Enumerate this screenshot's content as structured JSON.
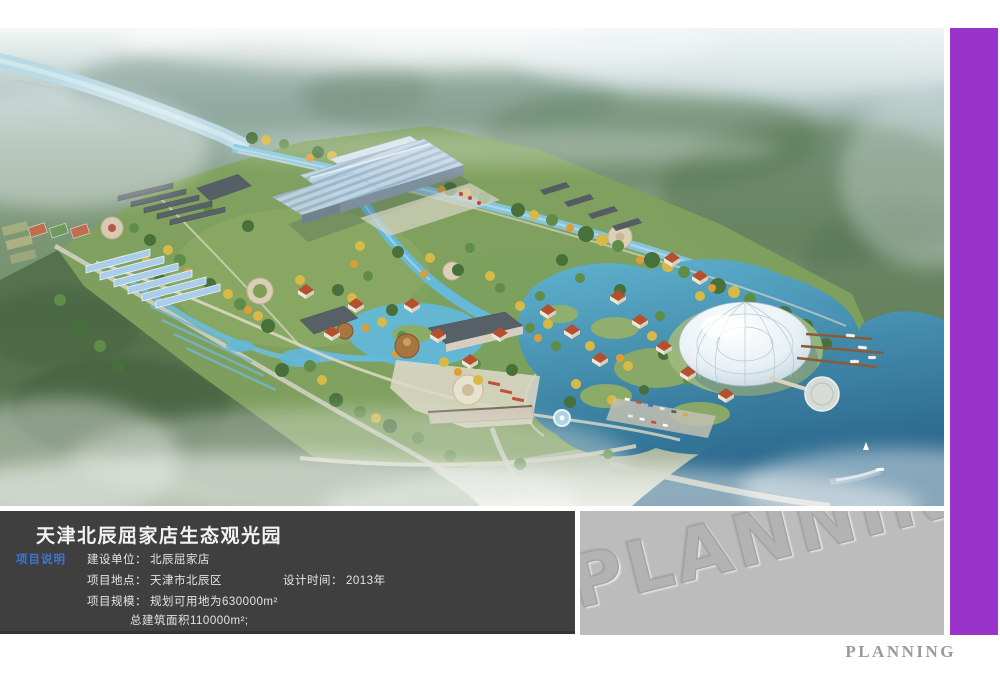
{
  "colors": {
    "accent_bar": "#9a33cc",
    "info_panel_bg": "#3f3f3f",
    "watermark_panel_bg": "#bcbcbc",
    "tag_blue": "#3b76d3",
    "footer_text": "#9a9a9a"
  },
  "info_panel": {
    "title": "天津北辰屈家店生态观光园",
    "tag": "项目说明",
    "unit_label": "建设单位：",
    "unit_value": "北辰屈家店",
    "location_label": "项目地点：",
    "location_value": "天津市北辰区",
    "time_label": "设计时间：",
    "time_value": "2013年",
    "scale_label": "项目规模：",
    "scale_value": "规划可用地为630000m²",
    "scale_value_2": "总建筑面积110000m²;"
  },
  "watermark_panel": {
    "text": "PLANNING"
  },
  "footer": {
    "text": "PLANNING"
  }
}
